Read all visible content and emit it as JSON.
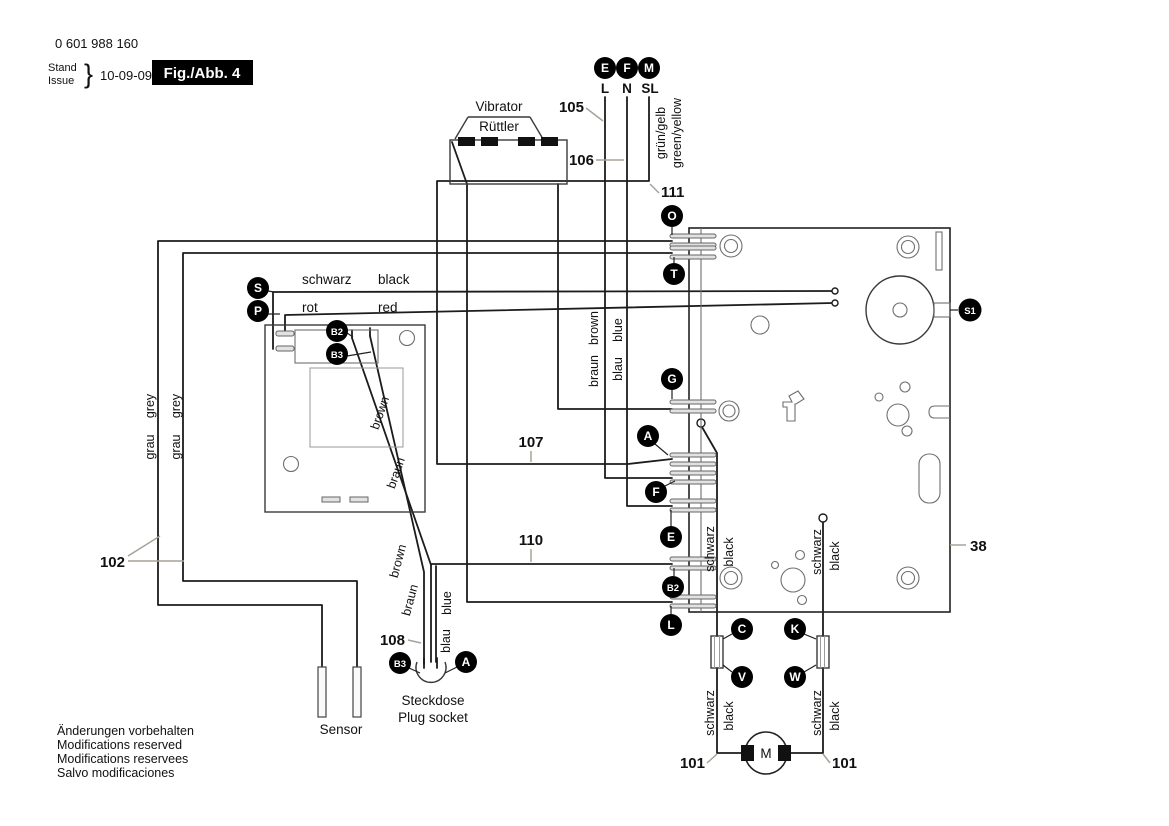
{
  "header": {
    "part_number": "0 601 988 160",
    "stand_label": "Stand",
    "issue_label": "Issue",
    "brace": "}",
    "date": "10-09-09",
    "figure_label": "Fig./Abb. 4"
  },
  "supply": {
    "terminals": [
      {
        "id": "E",
        "line": "L"
      },
      {
        "id": "F",
        "line": "N"
      },
      {
        "id": "M",
        "line": "SL"
      }
    ],
    "earth_de": "grün/gelb",
    "earth_en": "green/yellow"
  },
  "refs": {
    "r38": "38",
    "r101": "101",
    "r102": "102",
    "r105": "105",
    "r106": "106",
    "r107": "107",
    "r108": "108",
    "r110": "110",
    "r111": "111"
  },
  "points": {
    "A": "A",
    "B2": "B2",
    "B3": "B3",
    "C": "C",
    "E": "E",
    "F": "F",
    "G": "G",
    "K": "K",
    "L": "L",
    "O": "O",
    "P": "P",
    "S": "S",
    "S1": "S1",
    "T": "T",
    "V": "V",
    "W": "W"
  },
  "wire_colors": {
    "schwarz": "schwarz",
    "black": "black",
    "rot": "rot",
    "red": "red",
    "grau": "grau",
    "grey": "grey",
    "braun": "braun",
    "brown": "brown",
    "blau": "blau",
    "blue": "blue"
  },
  "components": {
    "vibrator_en": "Vibrator",
    "vibrator_de": "Rüttler",
    "socket_de": "Steckdose",
    "socket_en": "Plug socket",
    "sensor": "Sensor",
    "motor": "M"
  },
  "footer": {
    "line1": "Änderungen vorbehalten",
    "line2": "Modifications reserved",
    "line3": "Modifications reservees",
    "line4": "Salvo modificaciones"
  },
  "colors": {
    "wire": "#1c1c1c",
    "leader": "#a7a298",
    "label_bg": "#000000",
    "label_fg": "#ffffff"
  }
}
